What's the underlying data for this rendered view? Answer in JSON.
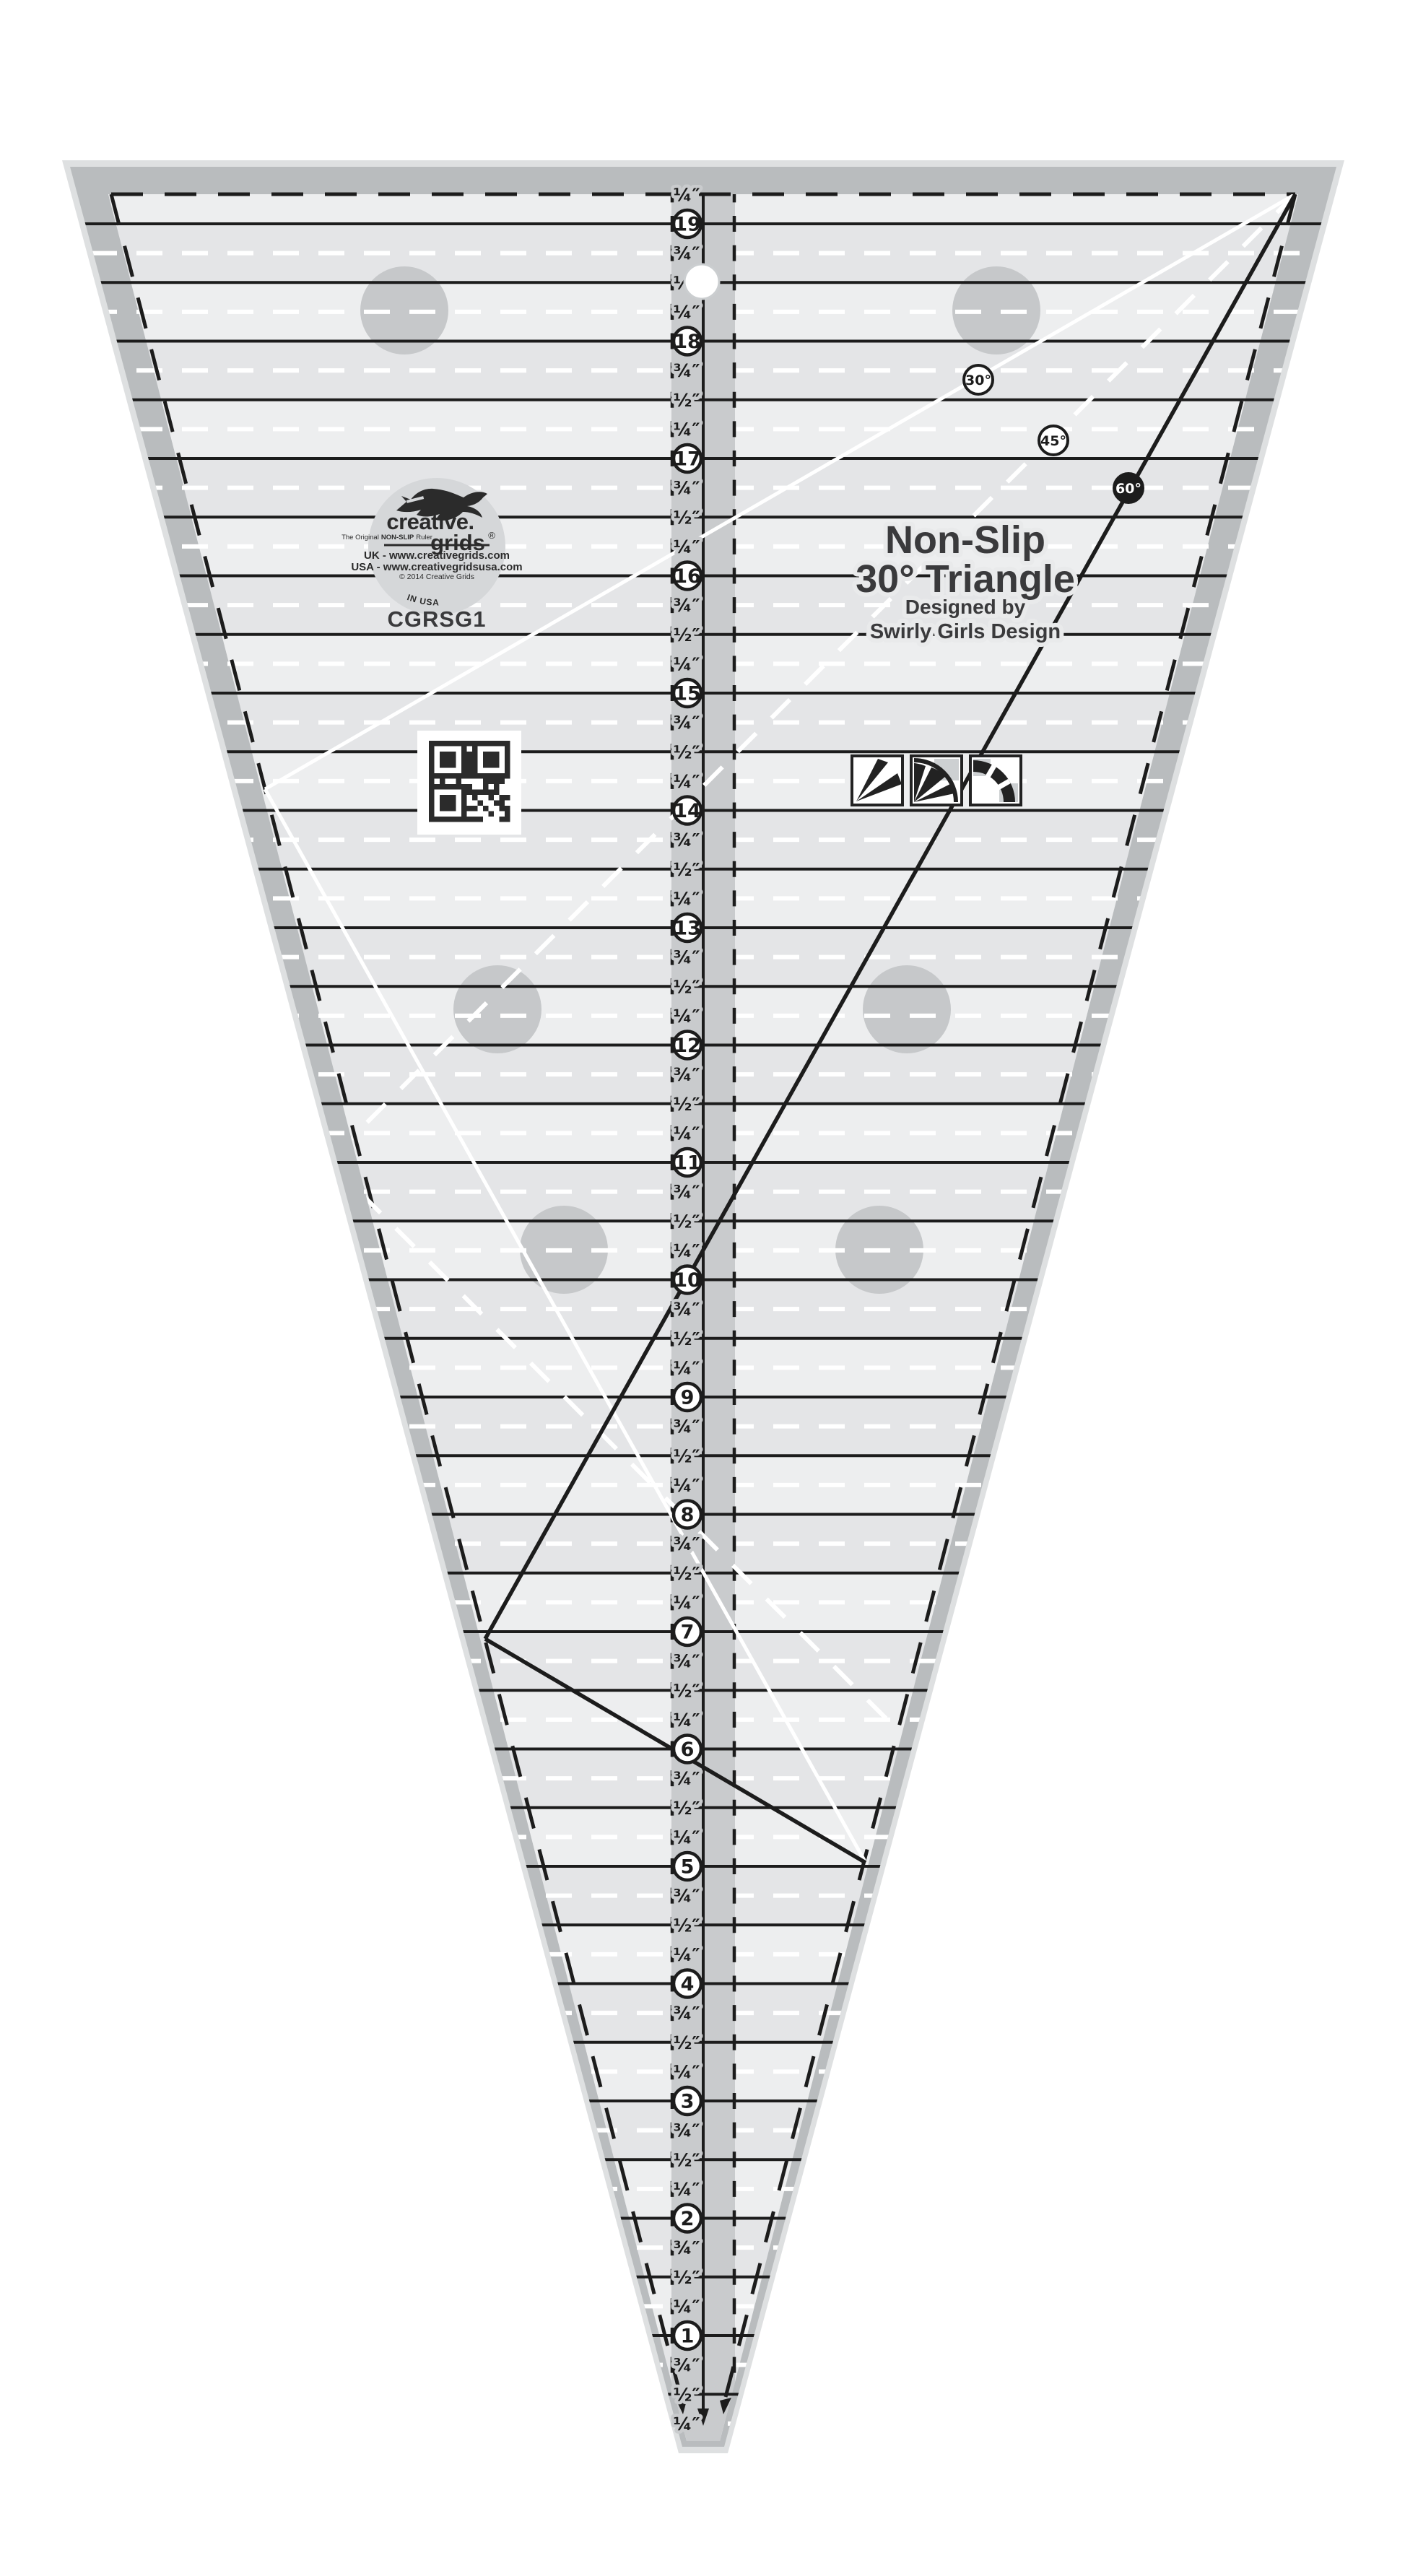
{
  "page": {
    "background": "#ffffff"
  },
  "ruler": {
    "model_code": "CGRSG1",
    "title": {
      "line1": "Non-Slip",
      "line2": "30° Triangle",
      "line3": "Designed by",
      "line4": "Swirly Girls Design"
    },
    "logo": {
      "brand_top": "creative.",
      "brand_bottom": "grids",
      "registered": "®",
      "tagline_pre": "The Original",
      "tagline_mid": "NON-SLIP",
      "tagline_post": "Ruler",
      "uk_line": "UK - www.creativegrids.com",
      "usa_line": "USA - www.creativegridsusa.com",
      "copyright_line": "© 2014 Creative Grids",
      "made_in": "MADE IN USA"
    },
    "scale": {
      "numbers": [
        19,
        18,
        17,
        16,
        15,
        14,
        13,
        12,
        11,
        10,
        9,
        8,
        7,
        6,
        5,
        4,
        3,
        2,
        1
      ],
      "quarter_label": "¼″",
      "half_label": "½″",
      "three_quarter_label": "¾″"
    },
    "angle_markers": [
      {
        "label": "30°",
        "style": "outline"
      },
      {
        "label": "45°",
        "style": "outline"
      },
      {
        "label": "60°",
        "style": "filled"
      }
    ],
    "colors": {
      "body": "#e4e5e7",
      "body_alt": "#edeeef",
      "edge_band": "#b9bcbe",
      "outer_edge": "#dee0e1",
      "center_column": "#c9cbcd",
      "grip_dot": "#c6c8ca",
      "line_black": "#1c1c1c",
      "line_white": "#ffffff",
      "text_dark": "#3a3a3c",
      "logo_disc": "#d5d7d9",
      "ink": "#2b2b2b"
    }
  }
}
